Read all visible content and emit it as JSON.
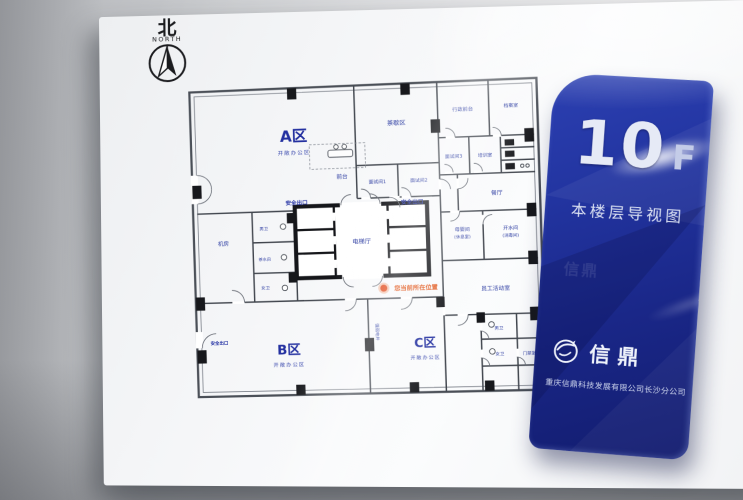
{
  "compass": {
    "hanzi": "北",
    "latin": "NORTH"
  },
  "plan": {
    "you_are_here": "您当前所在位置",
    "zones": {
      "a": {
        "name": "A区",
        "sub": "开敞办公区"
      },
      "b": {
        "name": "B区",
        "sub": "开敞办公区"
      },
      "c": {
        "name": "C区",
        "sub": "开敞办公区"
      }
    },
    "rooms": {
      "tea": "茶歇区",
      "admin": "行政前台",
      "archive": "档案室",
      "interview1": "面试间1",
      "interview2": "面试间2",
      "interview3": "面试间3",
      "training": "培训室",
      "reception": "前台",
      "dining": "餐厅",
      "exit": "安全出口",
      "elevator": "电梯厅",
      "machine": "机房",
      "male": "男卫",
      "female": "女卫",
      "pantry": "茶水间",
      "nursing": "母婴间",
      "nursing_sub": "(休息室)",
      "water": "开水间",
      "water_sub": "(消毒间)",
      "activity": "员工活动室",
      "access": "门禁室",
      "shaft": "强弱电井"
    }
  },
  "panel": {
    "floor": "10",
    "floor_unit": "F",
    "subtitle": "本楼层导视图",
    "brand": "信鼎",
    "company": "重庆信鼎科技发展有限公司长沙分公司"
  },
  "colors": {
    "label_blue": "#2c3ca2",
    "panel_blue": "#1a2788",
    "alert_orange": "#e2571c",
    "wall_gray": "#c9cbce",
    "board_white": "#f5f6f8"
  }
}
